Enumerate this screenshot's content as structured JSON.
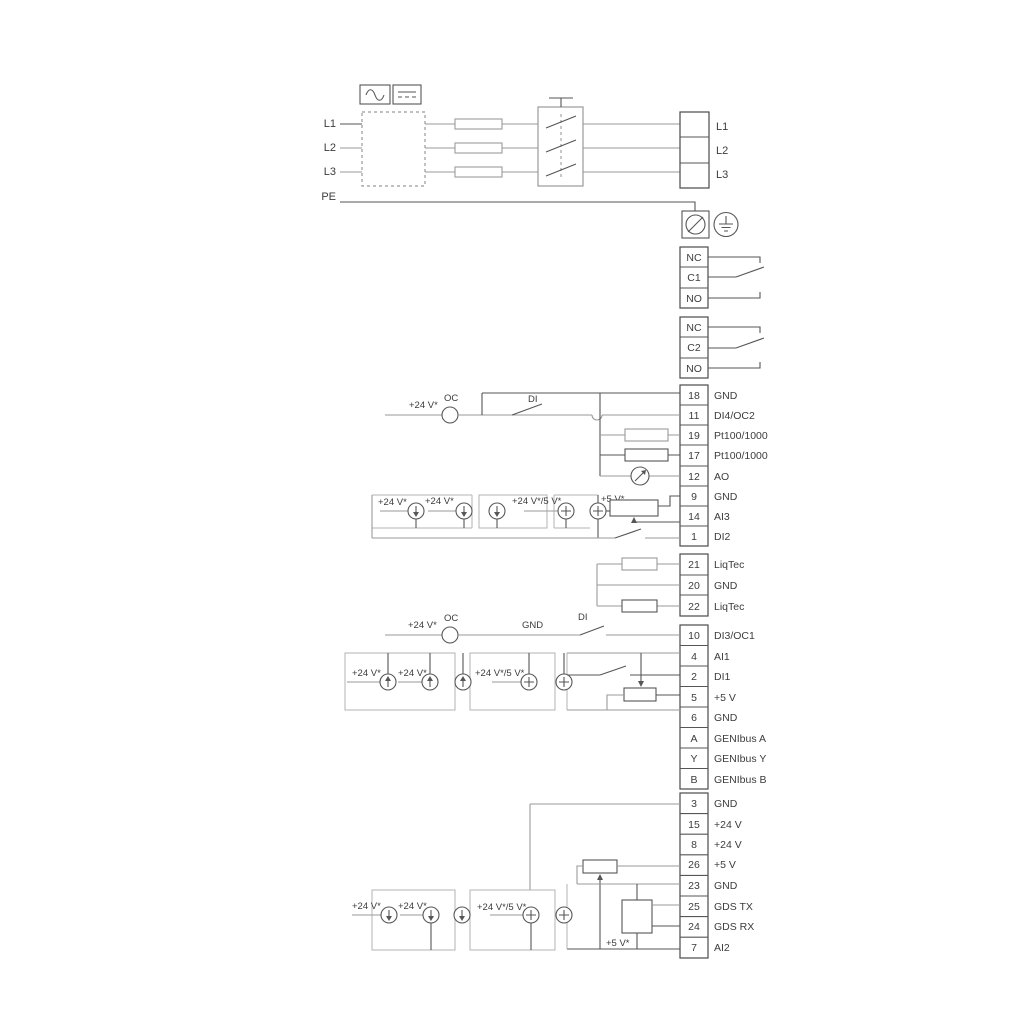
{
  "diagram": {
    "mains": {
      "inputs": [
        "L1",
        "L2",
        "L3"
      ],
      "pe": "PE",
      "output_terminals": [
        "L1",
        "L2",
        "L3"
      ]
    },
    "relay1": [
      "NC",
      "C1",
      "NO"
    ],
    "relay2": [
      "NC",
      "C2",
      "NO"
    ],
    "io_block1": [
      {
        "num": "18",
        "label": "GND"
      },
      {
        "num": "11",
        "label": "DI4/OC2"
      },
      {
        "num": "19",
        "label": "Pt100/1000"
      },
      {
        "num": "17",
        "label": "Pt100/1000"
      },
      {
        "num": "12",
        "label": "AO"
      },
      {
        "num": "9",
        "label": "GND"
      },
      {
        "num": "14",
        "label": "AI3"
      },
      {
        "num": "1",
        "label": "DI2"
      }
    ],
    "liqtec_block": [
      {
        "num": "21",
        "label": "LiqTec"
      },
      {
        "num": "20",
        "label": "GND"
      },
      {
        "num": "22",
        "label": "LiqTec"
      }
    ],
    "io_block2": [
      {
        "num": "10",
        "label": "DI3/OC1"
      },
      {
        "num": "4",
        "label": "AI1"
      },
      {
        "num": "2",
        "label": "DI1"
      },
      {
        "num": "5",
        "label": "+5 V"
      },
      {
        "num": "6",
        "label": "GND"
      },
      {
        "num": "A",
        "label": "GENIbus A"
      },
      {
        "num": "Y",
        "label": "GENIbus Y"
      },
      {
        "num": "B",
        "label": "GENIbus B"
      }
    ],
    "io_block3": [
      {
        "num": "3",
        "label": "GND"
      },
      {
        "num": "15",
        "label": "+24 V"
      },
      {
        "num": "8",
        "label": "+24 V"
      },
      {
        "num": "26",
        "label": "+5 V"
      },
      {
        "num": "23",
        "label": "GND"
      },
      {
        "num": "25",
        "label": "GDS TX"
      },
      {
        "num": "24",
        "label": "GDS RX"
      },
      {
        "num": "7",
        "label": "AI2"
      }
    ],
    "annotations": {
      "v24": "+24 V*",
      "v24_5": "+24 V*/5 V*",
      "v5": "+5 V*",
      "oc": "OC",
      "di": "DI",
      "gnd": "GND"
    },
    "colors": {
      "wire_dark": "#565656",
      "wire_gray": "#9a9a9a",
      "text": "#3c3c3c"
    }
  }
}
